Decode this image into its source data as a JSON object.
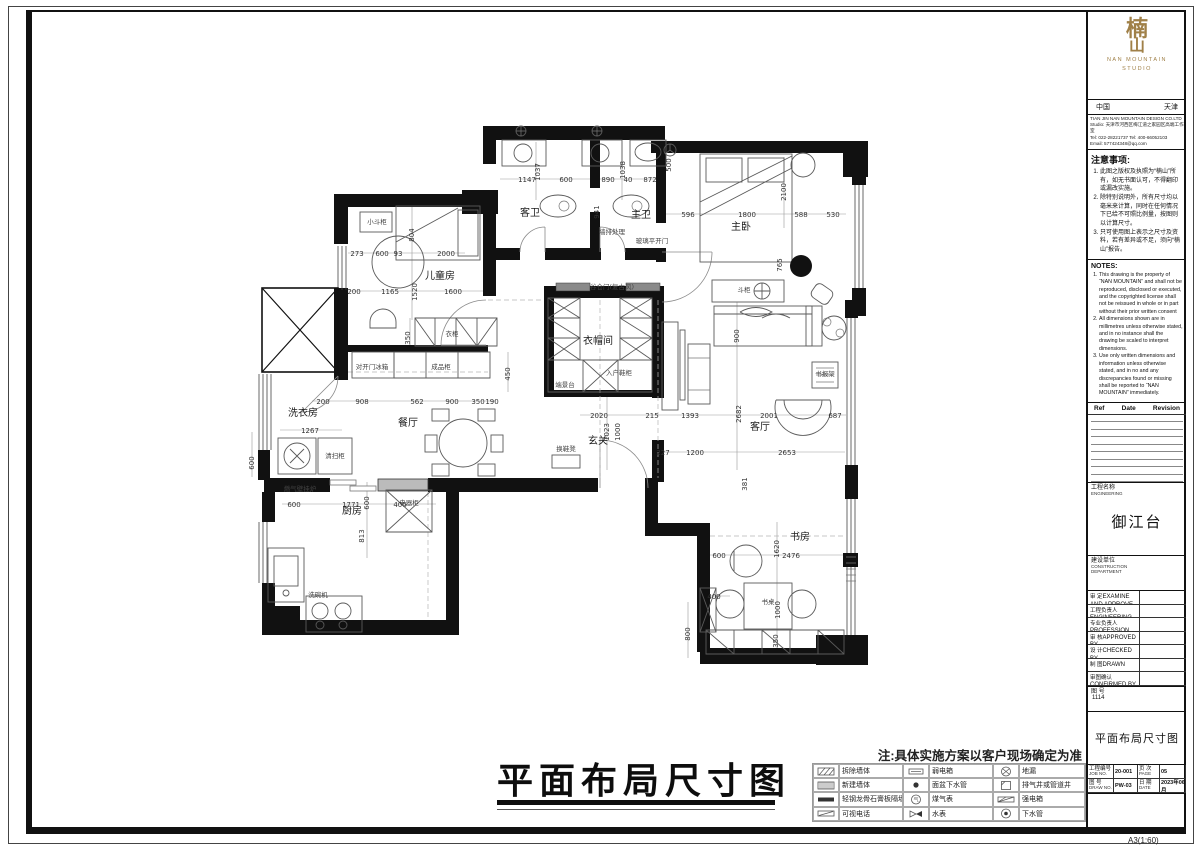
{
  "plan": {
    "big_title": "平面布局尺寸图",
    "site_note": "注:具体实施方案以客户现场确定为准",
    "rooms": [
      {
        "t": "客卫",
        "x": 530,
        "y": 216
      },
      {
        "t": "主卫",
        "x": 641,
        "y": 218
      },
      {
        "t": "主卧",
        "x": 741,
        "y": 230
      },
      {
        "t": "儿童房",
        "x": 440,
        "y": 279
      },
      {
        "t": "衣帽间",
        "x": 598,
        "y": 344
      },
      {
        "t": "玄关",
        "x": 598,
        "y": 444
      },
      {
        "t": "餐厅",
        "x": 408,
        "y": 426
      },
      {
        "t": "洗衣房",
        "x": 303,
        "y": 416
      },
      {
        "t": "厨房",
        "x": 352,
        "y": 514
      },
      {
        "t": "客厅",
        "x": 760,
        "y": 430
      },
      {
        "t": "书房",
        "x": 800,
        "y": 540
      }
    ],
    "annotations": [
      {
        "t": "小斗柜",
        "x": 377,
        "y": 224
      },
      {
        "t": "衣柜",
        "x": 452,
        "y": 336
      },
      {
        "t": "成品柜",
        "x": 441,
        "y": 369
      },
      {
        "t": "对开门冰箱",
        "x": 372,
        "y": 369
      },
      {
        "t": "端景台",
        "x": 565,
        "y": 387
      },
      {
        "t": "入户鞋柜",
        "x": 619,
        "y": 375
      },
      {
        "t": "谷仓门(复古风)",
        "x": 612,
        "y": 289
      },
      {
        "t": "换鞋凳",
        "x": 566,
        "y": 451
      },
      {
        "t": "斗柜",
        "x": 744,
        "y": 292
      },
      {
        "t": "书报架",
        "x": 825,
        "y": 376
      },
      {
        "t": "洗碗机",
        "x": 318,
        "y": 597
      },
      {
        "t": "清扫柜",
        "x": 335,
        "y": 458
      },
      {
        "t": "燃气壁挂炉",
        "x": 300,
        "y": 491
      },
      {
        "t": "电器柜",
        "x": 409,
        "y": 505
      },
      {
        "t": "书桌",
        "x": 768,
        "y": 604
      },
      {
        "t": "墙排处理",
        "x": 612,
        "y": 234
      },
      {
        "t": "玻璃平开门",
        "x": 652,
        "y": 243
      }
    ],
    "dims_h": [
      {
        "t": "1147",
        "x": 527,
        "y": 182
      },
      {
        "t": "600",
        "x": 566,
        "y": 182
      },
      {
        "t": "890",
        "x": 608,
        "y": 182
      },
      {
        "t": "40",
        "x": 628,
        "y": 182
      },
      {
        "t": "872",
        "x": 650,
        "y": 182
      },
      {
        "t": "596",
        "x": 688,
        "y": 217
      },
      {
        "t": "1800",
        "x": 747,
        "y": 217
      },
      {
        "t": "588",
        "x": 801,
        "y": 217
      },
      {
        "t": "530",
        "x": 833,
        "y": 217
      },
      {
        "t": "273",
        "x": 357,
        "y": 256
      },
      {
        "t": "600",
        "x": 382,
        "y": 256
      },
      {
        "t": "93",
        "x": 398,
        "y": 256
      },
      {
        "t": "2000",
        "x": 446,
        "y": 256
      },
      {
        "t": "200",
        "x": 354,
        "y": 294
      },
      {
        "t": "1165",
        "x": 390,
        "y": 294
      },
      {
        "t": "1600",
        "x": 453,
        "y": 294
      },
      {
        "t": "200",
        "x": 323,
        "y": 404
      },
      {
        "t": "908",
        "x": 362,
        "y": 404
      },
      {
        "t": "562",
        "x": 417,
        "y": 404
      },
      {
        "t": "900",
        "x": 452,
        "y": 404
      },
      {
        "t": "350",
        "x": 478,
        "y": 404
      },
      {
        "t": "190",
        "x": 492,
        "y": 404
      },
      {
        "t": "1267",
        "x": 310,
        "y": 433
      },
      {
        "t": "2020",
        "x": 599,
        "y": 418
      },
      {
        "t": "215",
        "x": 652,
        "y": 418
      },
      {
        "t": "1393",
        "x": 690,
        "y": 418
      },
      {
        "t": "2001",
        "x": 769,
        "y": 418
      },
      {
        "t": "687",
        "x": 835,
        "y": 418
      },
      {
        "t": "227",
        "x": 663,
        "y": 455
      },
      {
        "t": "1200",
        "x": 695,
        "y": 455
      },
      {
        "t": "2653",
        "x": 787,
        "y": 455
      },
      {
        "t": "600",
        "x": 294,
        "y": 507
      },
      {
        "t": "1771",
        "x": 351,
        "y": 507
      },
      {
        "t": "400",
        "x": 400,
        "y": 507
      },
      {
        "t": "600",
        "x": 719,
        "y": 558
      },
      {
        "t": "2476",
        "x": 791,
        "y": 558
      },
      {
        "t": "400",
        "x": 714,
        "y": 599
      }
    ],
    "dims_v": [
      {
        "t": "1037",
        "x": 540,
        "y": 172
      },
      {
        "t": "941",
        "x": 599,
        "y": 212
      },
      {
        "t": "1038",
        "x": 625,
        "y": 170
      },
      {
        "t": "500",
        "x": 671,
        "y": 165
      },
      {
        "t": "2100",
        "x": 786,
        "y": 192
      },
      {
        "t": "765",
        "x": 782,
        "y": 265
      },
      {
        "t": "804",
        "x": 414,
        "y": 235
      },
      {
        "t": "1520",
        "x": 417,
        "y": 292
      },
      {
        "t": "350",
        "x": 410,
        "y": 338
      },
      {
        "t": "450",
        "x": 510,
        "y": 374
      },
      {
        "t": "600",
        "x": 254,
        "y": 463
      },
      {
        "t": "600",
        "x": 369,
        "y": 503
      },
      {
        "t": "813",
        "x": 364,
        "y": 536
      },
      {
        "t": "1023",
        "x": 609,
        "y": 432
      },
      {
        "t": "1000",
        "x": 620,
        "y": 432
      },
      {
        "t": "2682",
        "x": 741,
        "y": 414
      },
      {
        "t": "900",
        "x": 739,
        "y": 336
      },
      {
        "t": "381",
        "x": 747,
        "y": 484
      },
      {
        "t": "1620",
        "x": 779,
        "y": 549
      },
      {
        "t": "800",
        "x": 690,
        "y": 634
      },
      {
        "t": "1000",
        "x": 780,
        "y": 610
      },
      {
        "t": "350",
        "x": 778,
        "y": 641
      }
    ]
  },
  "legend": {
    "items": [
      {
        "icon": "demolish-wall-icon",
        "label": "拆除墙体"
      },
      {
        "icon": "weak-current-box-icon",
        "label": "弱电箱"
      },
      {
        "icon": "floor-drain-icon",
        "label": "地漏"
      },
      {
        "icon": "new-wall-icon",
        "label": "新建墙体"
      },
      {
        "icon": "basin-drain-icon",
        "label": "面盆下水管"
      },
      {
        "icon": "exhaust-shaft-icon",
        "label": "排气井或管道井"
      },
      {
        "icon": "steel-keel-partition-icon",
        "label": "轻钢龙骨石膏板隔墙"
      },
      {
        "icon": "gas-meter-icon",
        "label": "煤气表"
      },
      {
        "icon": "strong-current-box-icon",
        "label": "强电箱"
      },
      {
        "icon": "video-phone-icon",
        "label": "可视电话"
      },
      {
        "icon": "water-meter-icon",
        "label": "水表"
      },
      {
        "icon": "drain-pipe-icon",
        "label": "下水管"
      }
    ]
  },
  "titleblock": {
    "logo": {
      "char1": "楠",
      "char2": "山",
      "brand1": "NAN MOUNTAIN",
      "brand2": "STUDIO"
    },
    "region_cn": "中国",
    "region_city": "天津",
    "company_lines": [
      "TIAN JIN NAN MOUNTAIN DESIGN CO.LTD",
      "Studio: 天津市河西区梅江道之家园区高端工作室",
      "Tel: 022-28221737  Tel: 400-66052103",
      "Email: 577424348@qq.com"
    ],
    "attention": {
      "heading": "注意事项:",
      "items": [
        "此图之版权及执照为“楠山”所有，如无书面认可，不得翻印或漏改实施。",
        "除特别说明外，所有尺寸均以毫米来计算，同时在任何情况下已给不可照比例量，按图则以计算尺寸。",
        "只可使用图上表示之尺寸及资料，若有差异或不足，须向“楠山”报告。"
      ]
    },
    "notes_en": {
      "heading": "NOTES:",
      "items": [
        "This drawing is the property of “NAN MOUNTAIN” and shall not be reproduced, disclosed or executed, and the copyrighted license shall not be reissued in whole or in part without their prior written consent",
        "All dimensions shown are in millimetres unless otherwise stated, and in no instance shall the drawing be scaled to interpret dimensions.",
        "Use only written dimensions and information unless otherwise stated, and in no and any discrepancies found or missing shall be reported to “NAN MOUNTAIN” immediately."
      ]
    },
    "revision": {
      "ref": "Ref",
      "date": "Date",
      "revision": "Revision"
    },
    "project": {
      "cn": "工程名称",
      "en": "ENGINEERING",
      "value": "御江台"
    },
    "construction": {
      "cn": "建设单位",
      "en1": "CONSTRUCTION",
      "en2": "DEPARTMENT"
    },
    "signs": [
      {
        "cn": "审  定",
        "en": "EXAMINE AND APPROVE"
      },
      {
        "cn": "工程负责人",
        "en": "ENGINEERING PRINCIPAL"
      },
      {
        "cn": "专业负责人",
        "en": "PROFESSION PRINCIPAL"
      },
      {
        "cn": "审  核",
        "en": "APPROVED BY"
      },
      {
        "cn": "设  计",
        "en": "CHECKED BY"
      },
      {
        "cn": "制  图",
        "en": "DRAWN"
      },
      {
        "cn": "审图确认",
        "en": "CONFIRMED BY"
      }
    ],
    "serial": {
      "cn": "图 号",
      "value": "1114"
    },
    "sheet_title": "平面布局尺寸图",
    "bottom_cells": [
      {
        "cn": "工程编号",
        "en": "JOB NO.",
        "value": "20-001"
      },
      {
        "cn": "页 次",
        "en": "PAGE",
        "value": "05"
      },
      {
        "cn": "图 号",
        "en": "DRAW NO.",
        "value": "PW-03"
      },
      {
        "cn": "日 期",
        "en": "DATE",
        "value": "2023年06月"
      }
    ],
    "corner_note": "A3(1:60)"
  }
}
